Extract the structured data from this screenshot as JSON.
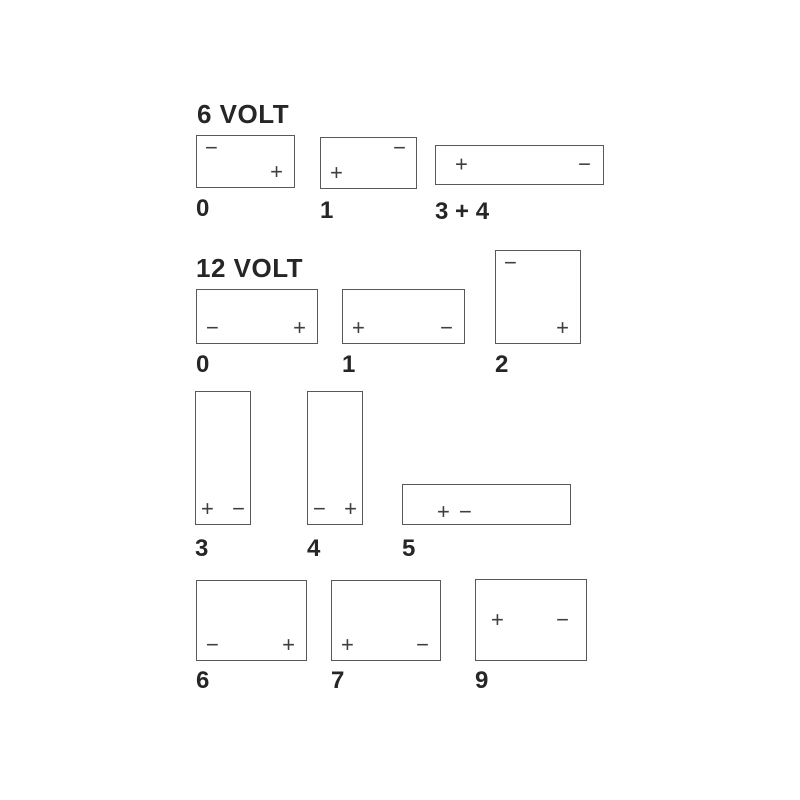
{
  "colors": {
    "background": "#ffffff",
    "battery_outline": "#595959",
    "text": "#262626",
    "terminal_symbol": "#3f3f3f"
  },
  "six_volt": {
    "heading": "6 VOLT",
    "batteries": [
      {
        "label": "0",
        "negative": {
          "symbol": "−",
          "position": "top-left"
        },
        "positive": {
          "symbol": "+",
          "position": "bottom-right"
        }
      },
      {
        "label": "1",
        "positive": {
          "symbol": "+",
          "position": "bottom-left"
        },
        "negative": {
          "symbol": "−",
          "position": "top-right"
        }
      },
      {
        "label": "3 + 4",
        "positive": {
          "symbol": "+",
          "position": "middle-left"
        },
        "negative": {
          "symbol": "−",
          "position": "middle-right"
        }
      }
    ]
  },
  "twelve_volt": {
    "heading": "12 VOLT",
    "batteries": [
      {
        "label": "0",
        "negative": {
          "symbol": "−",
          "position": "bottom-left"
        },
        "positive": {
          "symbol": "+",
          "position": "bottom-right"
        }
      },
      {
        "label": "1",
        "positive": {
          "symbol": "+",
          "position": "bottom-left"
        },
        "negative": {
          "symbol": "−",
          "position": "bottom-right"
        }
      },
      {
        "label": "2",
        "negative": {
          "symbol": "−",
          "position": "top-left"
        },
        "positive": {
          "symbol": "+",
          "position": "bottom-right"
        }
      },
      {
        "label": "3",
        "positive": {
          "symbol": "+",
          "position": "bottom-left"
        },
        "negative": {
          "symbol": "−",
          "position": "bottom-right"
        }
      },
      {
        "label": "4",
        "negative": {
          "symbol": "−",
          "position": "bottom-left"
        },
        "positive": {
          "symbol": "+",
          "position": "bottom-right"
        }
      },
      {
        "label": "5",
        "positive": {
          "symbol": "+",
          "position": "middle-left"
        },
        "negative": {
          "symbol": "−",
          "position": "middle-left-adjacent"
        }
      },
      {
        "label": "6",
        "negative": {
          "symbol": "−",
          "position": "bottom-left"
        },
        "positive": {
          "symbol": "+",
          "position": "bottom-right"
        }
      },
      {
        "label": "7",
        "positive": {
          "symbol": "+",
          "position": "bottom-left"
        },
        "negative": {
          "symbol": "−",
          "position": "bottom-right"
        }
      },
      {
        "label": "9",
        "positive": {
          "symbol": "+",
          "position": "middle-left"
        },
        "negative": {
          "symbol": "−",
          "position": "middle-right"
        }
      }
    ]
  }
}
